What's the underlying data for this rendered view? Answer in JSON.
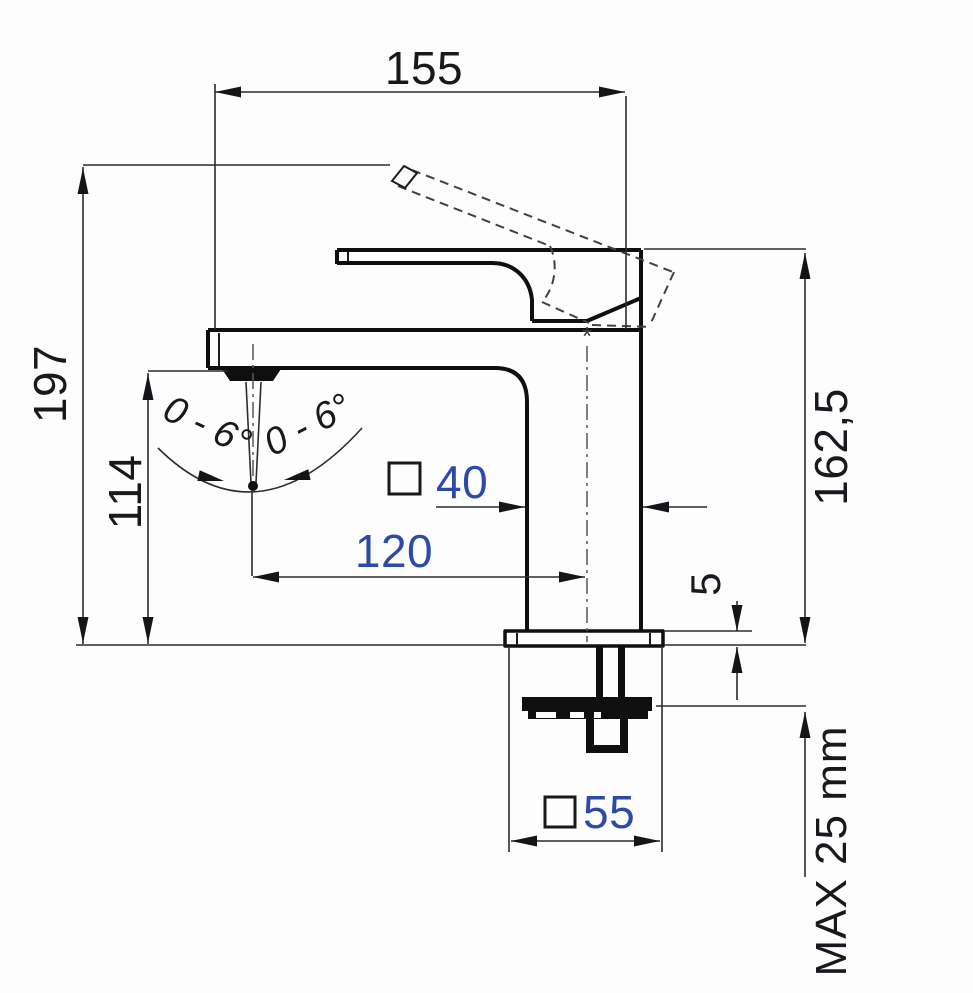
{
  "meta": {
    "title": "Single-lever basin mixer — dimensional technical drawing"
  },
  "dims": {
    "width_overall": "155",
    "height_overall": "197",
    "spout_height": "114",
    "body_height": "162,5",
    "spout_reach": "120",
    "body_section": "40",
    "base_section": "55",
    "plate_thickness": "5",
    "max_panel": "MAX 25 mm"
  },
  "angles": {
    "left": "0 - 6°",
    "right": "0 - 6°"
  },
  "marks": {
    "footnote": "*"
  },
  "colors": {
    "background": "#fdfdfd",
    "thin_line": "#2b2d31",
    "thick_line": "#0f0f10",
    "dashed_line": "#3f4144",
    "dim_text_dark": "#17191d",
    "dim_text_blue": "#2c4aa8"
  }
}
